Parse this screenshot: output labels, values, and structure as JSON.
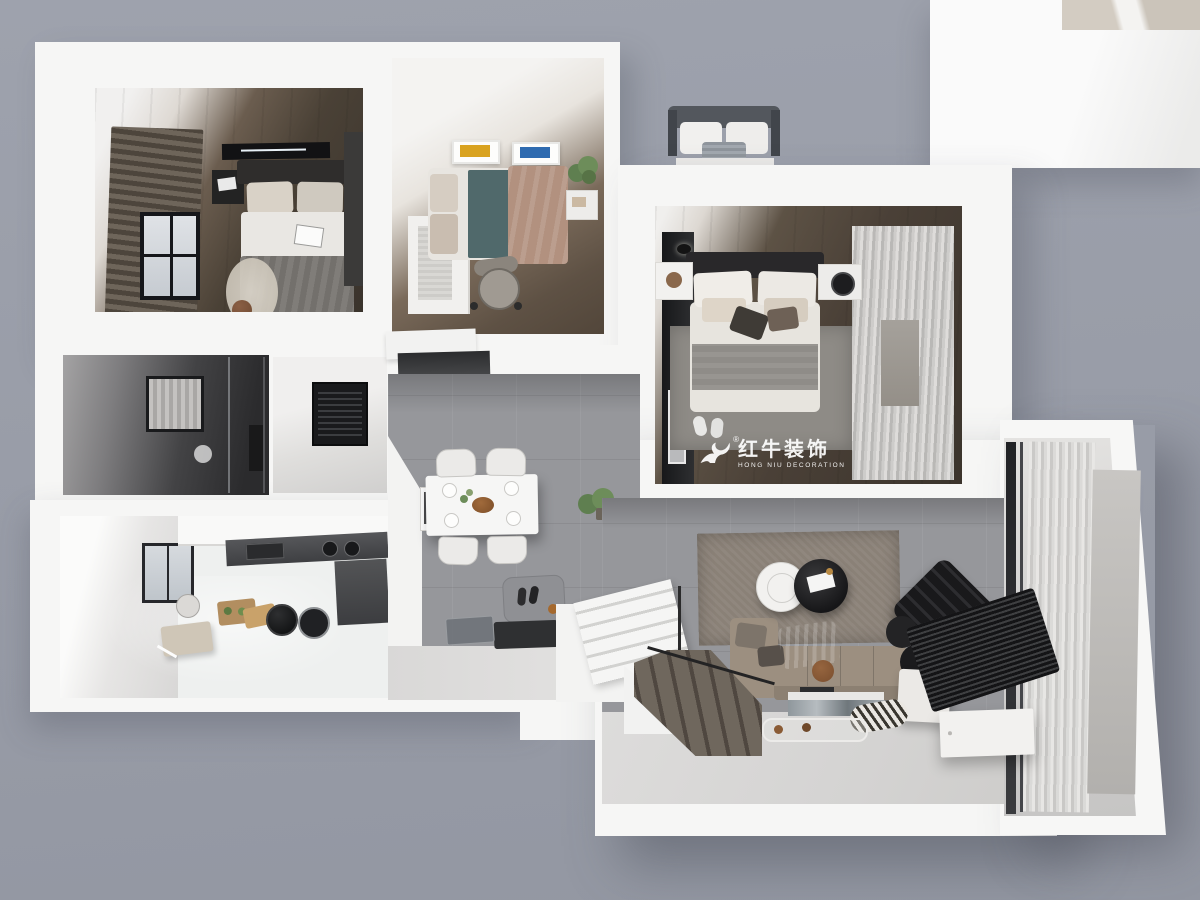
{
  "watermark": {
    "brand_cn": "红牛装饰",
    "brand_en": "HONG NIU DECORATION",
    "registered": "®",
    "icon": "bull-logo"
  },
  "colors": {
    "background_gray": "#9a9ea9",
    "wall_white": "#f6f6f5",
    "wood_floor_dark": "#4a4036",
    "tile_gray": "#96979b",
    "marble_white": "#eff0ef",
    "entry_floor_light": "#dcdbda",
    "rug_taupe": "#8a8177",
    "sofa_taupe": "#9c8f80",
    "bed_teal": "#50696b",
    "bed_mauve": "#b2917f",
    "art_yellow": "#d9a321",
    "art_blue": "#2f6bb0",
    "counter_dark": "#4a4b4d",
    "curtain_sheer": "#d8d7d5",
    "stair_wood": "#6f675d"
  },
  "scene": {
    "type": "3d-rendered-floor-plan-top-view",
    "rooms": [
      "master-bedroom",
      "second-bedroom",
      "guest-bedroom",
      "bathroom",
      "storage-room",
      "kitchen",
      "dining-area",
      "entry",
      "staircase",
      "living-room",
      "balcony"
    ]
  }
}
